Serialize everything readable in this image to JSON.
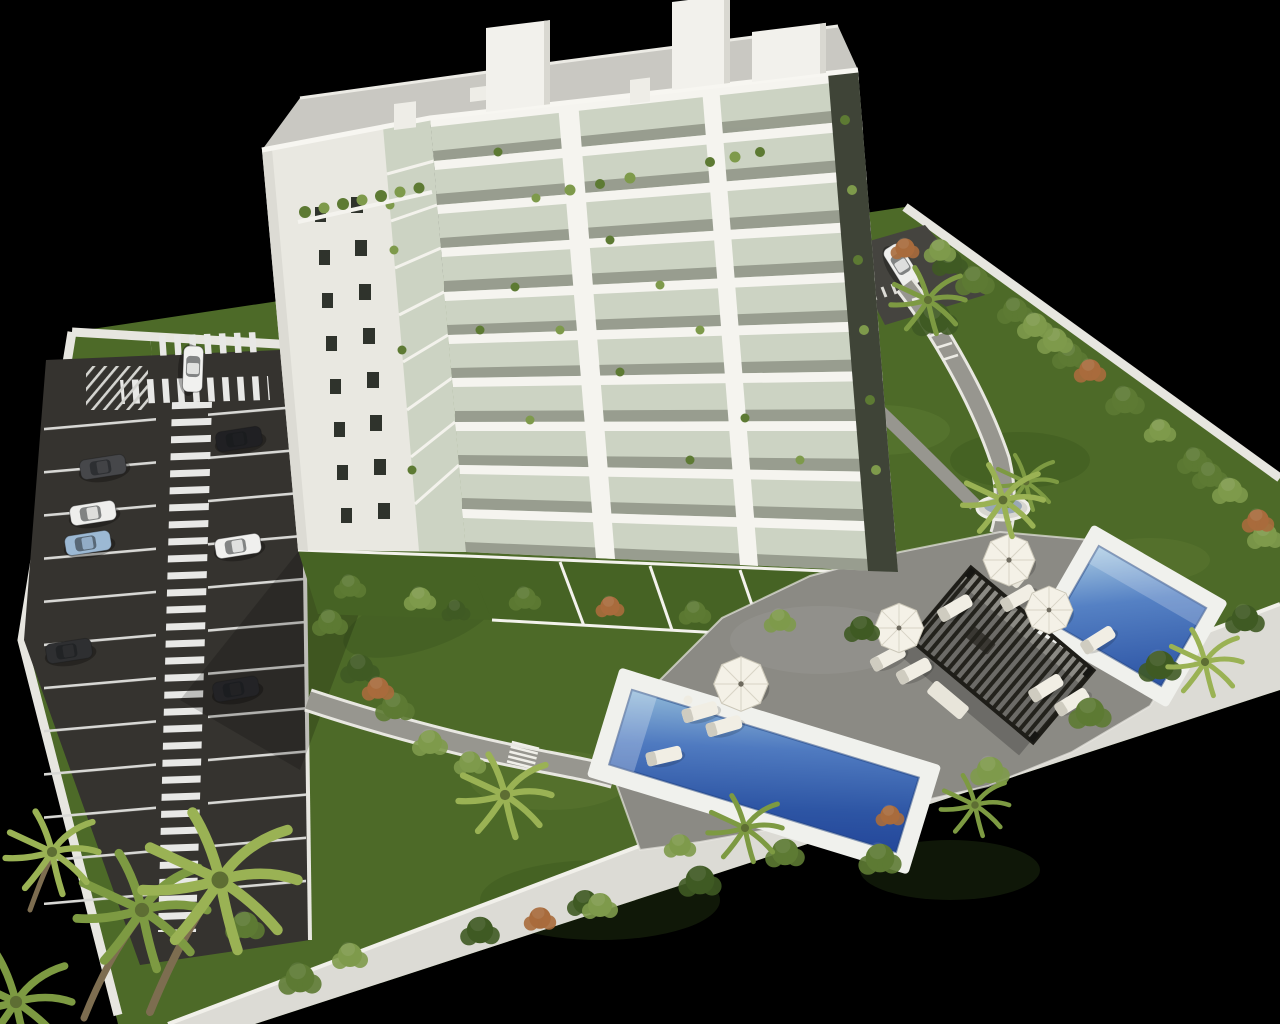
{
  "scene": {
    "description": "Aerial 3D architectural rendering of a white apartment tower with parking lot, landscaped gardens, pergola and two swimming pools on a black background",
    "palette": {
      "background": "#000000",
      "grass": "#4d6a28",
      "grass_dark": "#36511c",
      "grass_light": "#6d8a3a",
      "asphalt": "#35332f",
      "marking": "#e8e8e6",
      "wall": "#dcdbd5",
      "wall_bright": "#efeee8",
      "path": "#97968f",
      "deck": "#8b8a84",
      "facade": "#f2f1ec",
      "facade_shade": "#e9e8e1",
      "facade_edge": "#dcdbd4",
      "roof": "#c9c8c2",
      "window": "#2f332c",
      "glass": "#ccd3c3",
      "balcony_shadow": "#8f9486",
      "corner_shadow": "#3f4437",
      "water_light": "#8fb8d8",
      "water": "#4f7ac0",
      "water_deep": "#24479a",
      "coping": "#f0f1ed",
      "pergola": "#24231d",
      "umbrella": "#f4f1e7",
      "lounger": "#f1eee4",
      "shrub_dark": "#3f5a23",
      "shrub": "#5d7a33",
      "shrub_light": "#7e9a4b",
      "shrub_accent": "#a86b3c",
      "palm": "#7d9a42",
      "palm_light": "#9ab254",
      "trunk": "#7d6d50"
    },
    "building": {
      "floors_visible": 10,
      "roof_bulkheads": 3
    },
    "parking": {
      "crosswalks": 2,
      "walkway_style": "zebra-striped",
      "cars": [
        {
          "label": "white-hatchback-at-entrance",
          "color": "#f1f1ef"
        },
        {
          "label": "gray-car",
          "color": "#46474a"
        },
        {
          "label": "black-car",
          "color": "#202023"
        },
        {
          "label": "white-car",
          "color": "#eeeeec"
        },
        {
          "label": "light-blue-car",
          "color": "#9cb9d4"
        },
        {
          "label": "dark-car",
          "color": "#2e2f31"
        },
        {
          "label": "black-sedan",
          "color": "#232326"
        },
        {
          "label": "white-sedan",
          "color": "#f0f0ee"
        },
        {
          "label": "white-car-back-road",
          "color": "#efefed"
        }
      ]
    },
    "garden": {
      "pools": 2,
      "pergolas": 1,
      "umbrellas": 4,
      "sun_loungers": 10,
      "palm_trees": 9
    }
  }
}
